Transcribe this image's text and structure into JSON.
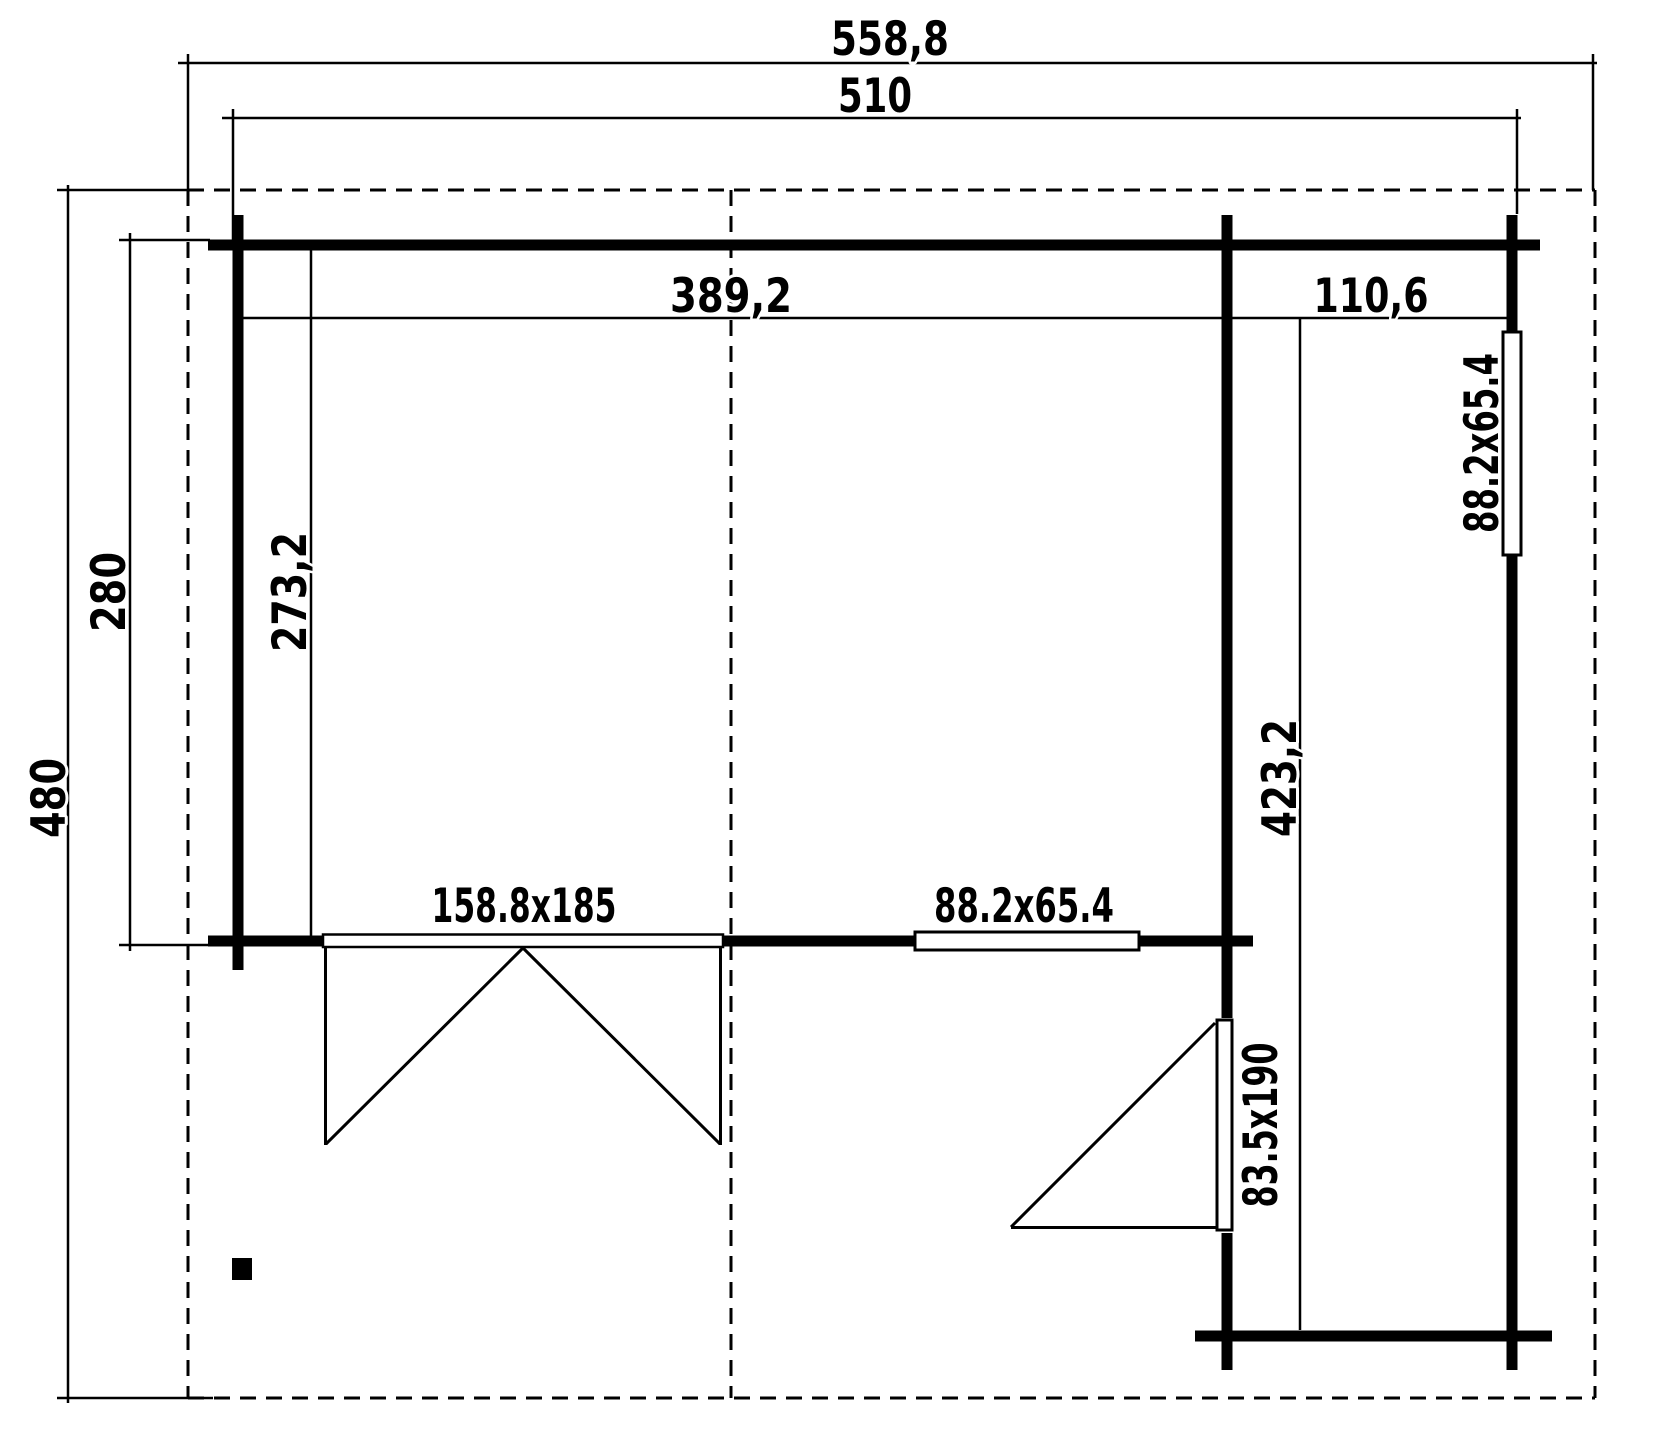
{
  "plan": {
    "dimensions": {
      "roof_width": "558,8",
      "building_width": "510",
      "roof_depth": "480",
      "main_building_depth": "280",
      "main_room_inner_width": "389,2",
      "main_room_inner_depth": "273,2",
      "annex_inner_width": "110,6",
      "annex_inner_depth": "423,2"
    },
    "openings": {
      "double_door_size": "158.8x185",
      "front_window_size": "88.2x65.4",
      "side_window_size": "88.2x65.4",
      "annex_door_size": "83.5x190"
    },
    "colors": {
      "line": "#000000",
      "background": "#ffffff"
    }
  }
}
